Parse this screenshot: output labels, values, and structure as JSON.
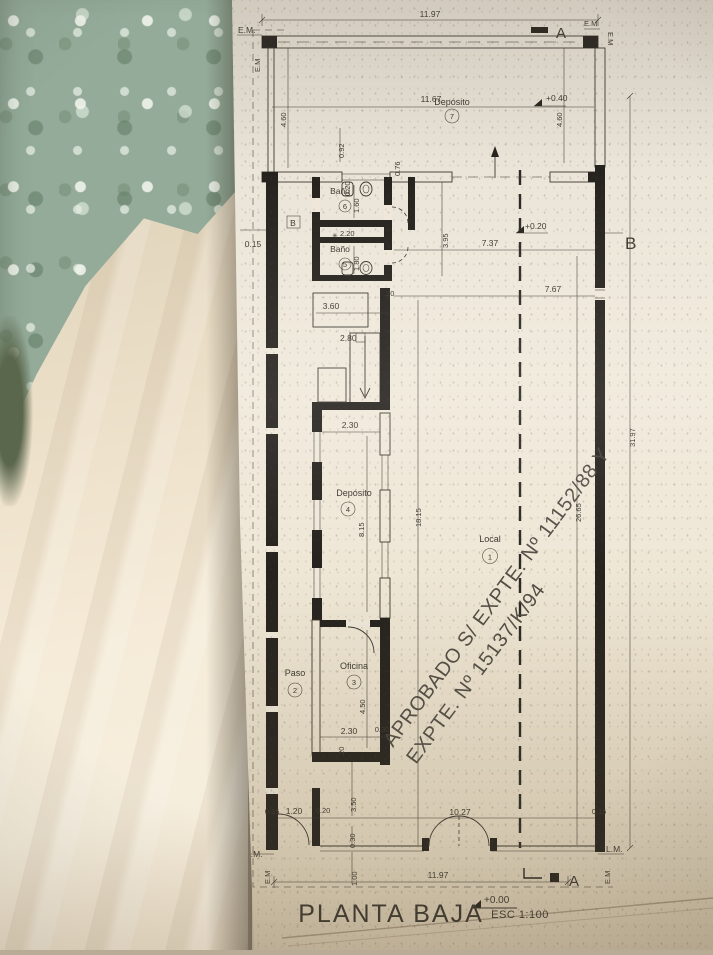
{
  "photo": {
    "scene": "architectural floor plan sheet photographed lying on patterned green fabric and a cream blanket",
    "paper_color": "#efe8da",
    "fabric_green": "#94ab99",
    "fabric_cream": "#f1e7d2",
    "ink_color": "#3b372f"
  },
  "plan": {
    "title": "PLANTA BAJA",
    "scale_label": "ESC 1:100",
    "stamp": {
      "line1": "APROBADO S/ EXPTE. Nº 11152/88 Y",
      "line2": "EXPTE. Nº 15137/K/94"
    },
    "rooms": [
      {
        "name": "Depósito",
        "number": "7"
      },
      {
        "name": "Baño",
        "number": "6"
      },
      {
        "name": "Baño",
        "number": "5"
      },
      {
        "name": "Depósito",
        "number": "4"
      },
      {
        "name": "Local",
        "number": "1"
      },
      {
        "name": "Oficina",
        "number": "3"
      },
      {
        "name": "Paso",
        "number": "2"
      }
    ],
    "levels": {
      "zero": "+0.00",
      "upper": "+0.40",
      "mid": "+0.20"
    },
    "markers": {
      "a": "A",
      "b": "B",
      "em": "E.M",
      "em_dot": "E.M.",
      "lm": "L.M."
    },
    "symbols": {
      "shaft_star": "✳"
    },
    "dims": {
      "d1197t": "11.97",
      "d1167": "11.67",
      "d460l": "4.60",
      "d460r": "4.60",
      "d092": "0.92",
      "d020top": "0.20",
      "d076": "0.76",
      "d160": "1.60",
      "d180": "1.80",
      "d220": "2.20",
      "d395": "3.95",
      "d737": "7.37",
      "d015b": "0.15",
      "d20stair": ".20",
      "d767": "7.67",
      "d360": "3.60",
      "d280": "2.80",
      "d230dep": "2.30",
      "d815": "8.15",
      "d1815": "18.15",
      "d2665": "26.65",
      "d3197": "31.97",
      "d450": "4.50",
      "d230of": "2.30",
      "d030of": "0.30",
      "d20of": ".20",
      "d015fl": "0.15",
      "d120": "1.20",
      "d020fp": "0.20",
      "d350": "3.50",
      "d030f": "0.30",
      "d100": "1.00",
      "d1027": "10.27",
      "d1197b": "11.97",
      "d015fr": "0.15"
    }
  }
}
